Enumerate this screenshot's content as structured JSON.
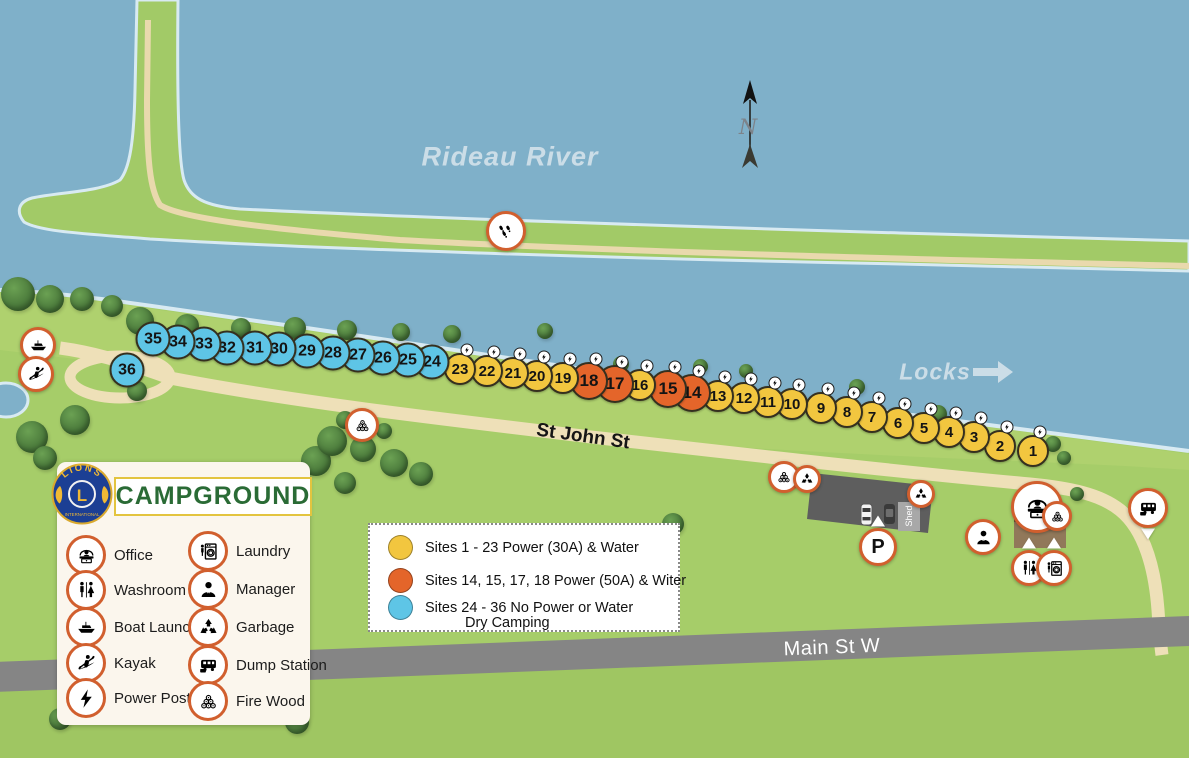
{
  "map": {
    "labels": {
      "river": "Rideau River",
      "locks": "Locks",
      "st_john": "St John St",
      "main_st": "Main St W",
      "shed": "Shed",
      "parking": "P",
      "north": "N"
    },
    "colors": {
      "river": "#7FB0C9",
      "shore": "#D8EAF2",
      "land": "#A6CD69",
      "path_tan": "#ECDCB2",
      "main_road_gray": "#858585",
      "site_power30": "#F2C63F",
      "site_power50": "#E4652A",
      "site_dry": "#5EC5E6",
      "icon_ring_orange": "#D15F2E"
    },
    "pois": [
      {
        "type": "boat-launch",
        "x": 38,
        "y": 345,
        "size": 30
      },
      {
        "type": "kayak",
        "x": 36,
        "y": 374,
        "size": 30
      },
      {
        "type": "footprints",
        "x": 506,
        "y": 231,
        "size": 34
      },
      {
        "type": "firewood",
        "x": 362,
        "y": 425,
        "size": 28
      },
      {
        "type": "firewood",
        "x": 784,
        "y": 477,
        "size": 26
      },
      {
        "type": "recycle",
        "x": 807,
        "y": 479,
        "size": 22
      },
      {
        "type": "recycle",
        "x": 921,
        "y": 494,
        "size": 22
      },
      {
        "type": "manager",
        "x": 983,
        "y": 537,
        "size": 30
      },
      {
        "type": "office",
        "x": 1037,
        "y": 507,
        "size": 46
      },
      {
        "type": "firewood",
        "x": 1057,
        "y": 516,
        "size": 24
      },
      {
        "type": "washroom",
        "x": 1029,
        "y": 568,
        "size": 30,
        "pointer": "top"
      },
      {
        "type": "laundry",
        "x": 1054,
        "y": 568,
        "size": 30,
        "pointer": "top"
      },
      {
        "type": "parking",
        "x": 878,
        "y": 547,
        "size": 32,
        "pointer": "top"
      },
      {
        "type": "dump-station",
        "x": 1148,
        "y": 508,
        "size": 34,
        "pointer": "bottom"
      }
    ],
    "trees": [
      [
        18,
        294,
        34
      ],
      [
        50,
        299,
        28
      ],
      [
        82,
        299,
        24
      ],
      [
        112,
        306,
        22
      ],
      [
        140,
        321,
        28
      ],
      [
        187,
        326,
        24
      ],
      [
        241,
        328,
        20
      ],
      [
        295,
        328,
        22
      ],
      [
        347,
        330,
        20
      ],
      [
        401,
        332,
        18
      ],
      [
        452,
        334,
        18
      ],
      [
        545,
        331,
        16
      ],
      [
        621,
        364,
        16
      ],
      [
        700,
        366,
        15
      ],
      [
        746,
        371,
        14
      ],
      [
        857,
        387,
        16
      ],
      [
        938,
        414,
        18
      ],
      [
        1053,
        444,
        16
      ],
      [
        1064,
        458,
        14
      ],
      [
        137,
        391,
        20
      ],
      [
        75,
        420,
        30
      ],
      [
        32,
        437,
        32
      ],
      [
        45,
        458,
        24
      ],
      [
        316,
        461,
        30
      ],
      [
        332,
        441,
        30
      ],
      [
        363,
        449,
        26
      ],
      [
        394,
        463,
        28
      ],
      [
        421,
        474,
        24
      ],
      [
        345,
        483,
        22
      ],
      [
        673,
        524,
        22
      ],
      [
        1077,
        494,
        14
      ],
      [
        297,
        722,
        24
      ],
      [
        60,
        719,
        22
      ],
      [
        345,
        420,
        18
      ],
      [
        384,
        431,
        16
      ]
    ]
  },
  "legend": {
    "brand": {
      "lions": "LIONS",
      "international": "INTERNATIONAL",
      "letter": "L"
    },
    "title": "CAMPGROUND",
    "items": [
      {
        "icon": "office",
        "label": "Office",
        "x": 83,
        "y": 555
      },
      {
        "icon": "washroom",
        "label": "Washroom",
        "x": 83,
        "y": 590
      },
      {
        "icon": "boat-launch",
        "label": "Boat Launch",
        "x": 83,
        "y": 627
      },
      {
        "icon": "kayak",
        "label": "Kayak",
        "x": 83,
        "y": 663
      },
      {
        "icon": "power-post",
        "label": "Power Post",
        "x": 83,
        "y": 698
      },
      {
        "icon": "laundry",
        "label": "Laundry",
        "x": 205,
        "y": 551
      },
      {
        "icon": "manager",
        "label": "Manager",
        "x": 205,
        "y": 589
      },
      {
        "icon": "garbage",
        "label": "Garbage",
        "x": 205,
        "y": 627
      },
      {
        "icon": "dump-station",
        "label": "Dump Station",
        "x": 205,
        "y": 665
      },
      {
        "icon": "firewood",
        "label": "Fire Wood",
        "x": 205,
        "y": 701
      }
    ]
  },
  "sites_legend": {
    "rows": [
      {
        "color": "#F2C63F",
        "label": "Sites 1 - 23  Power (30A) & Water"
      },
      {
        "color": "#E4652A",
        "label": "Sites 14, 15, 17, 18  Power (50A) & Witer"
      },
      {
        "color": "#5EC5E6",
        "label": "Sites 24 - 36  No Power or Water",
        "label2": "Dry Camping"
      }
    ]
  },
  "sites": [
    {
      "n": 1,
      "type": "p30",
      "x": 1033,
      "y": 451
    },
    {
      "n": 2,
      "type": "p30",
      "x": 1000,
      "y": 446
    },
    {
      "n": 3,
      "type": "p30",
      "x": 974,
      "y": 437
    },
    {
      "n": 4,
      "type": "p30",
      "x": 949,
      "y": 432
    },
    {
      "n": 5,
      "type": "p30",
      "x": 924,
      "y": 428
    },
    {
      "n": 6,
      "type": "p30",
      "x": 898,
      "y": 423
    },
    {
      "n": 7,
      "type": "p30",
      "x": 872,
      "y": 417
    },
    {
      "n": 8,
      "type": "p30",
      "x": 847,
      "y": 412
    },
    {
      "n": 9,
      "type": "p30",
      "x": 821,
      "y": 408
    },
    {
      "n": 10,
      "type": "p30",
      "x": 792,
      "y": 404
    },
    {
      "n": 11,
      "type": "p30",
      "x": 768,
      "y": 402
    },
    {
      "n": 12,
      "type": "p30",
      "x": 744,
      "y": 398
    },
    {
      "n": 13,
      "type": "p30",
      "x": 718,
      "y": 396
    },
    {
      "n": 14,
      "type": "p50",
      "x": 692,
      "y": 393
    },
    {
      "n": 15,
      "type": "p50",
      "x": 668,
      "y": 389
    },
    {
      "n": 16,
      "type": "p30",
      "x": 640,
      "y": 385
    },
    {
      "n": 17,
      "type": "p50",
      "x": 615,
      "y": 384
    },
    {
      "n": 18,
      "type": "p50",
      "x": 589,
      "y": 381
    },
    {
      "n": 19,
      "type": "p30",
      "x": 563,
      "y": 378
    },
    {
      "n": 20,
      "type": "p30",
      "x": 537,
      "y": 376
    },
    {
      "n": 21,
      "type": "p30",
      "x": 513,
      "y": 373
    },
    {
      "n": 22,
      "type": "p30",
      "x": 487,
      "y": 371
    },
    {
      "n": 23,
      "type": "p30",
      "x": 460,
      "y": 369
    },
    {
      "n": 24,
      "type": "dry",
      "x": 432,
      "y": 362
    },
    {
      "n": 25,
      "type": "dry",
      "x": 408,
      "y": 360
    },
    {
      "n": 26,
      "type": "dry",
      "x": 383,
      "y": 358
    },
    {
      "n": 27,
      "type": "dry",
      "x": 358,
      "y": 355
    },
    {
      "n": 28,
      "type": "dry",
      "x": 333,
      "y": 353
    },
    {
      "n": 29,
      "type": "dry",
      "x": 307,
      "y": 351
    },
    {
      "n": 30,
      "type": "dry",
      "x": 279,
      "y": 349
    },
    {
      "n": 31,
      "type": "dry",
      "x": 255,
      "y": 348
    },
    {
      "n": 32,
      "type": "dry",
      "x": 227,
      "y": 348
    },
    {
      "n": 33,
      "type": "dry",
      "x": 204,
      "y": 344
    },
    {
      "n": 34,
      "type": "dry",
      "x": 178,
      "y": 342
    },
    {
      "n": 35,
      "type": "dry",
      "x": 153,
      "y": 339
    },
    {
      "n": 36,
      "type": "dry",
      "x": 127,
      "y": 370
    }
  ]
}
